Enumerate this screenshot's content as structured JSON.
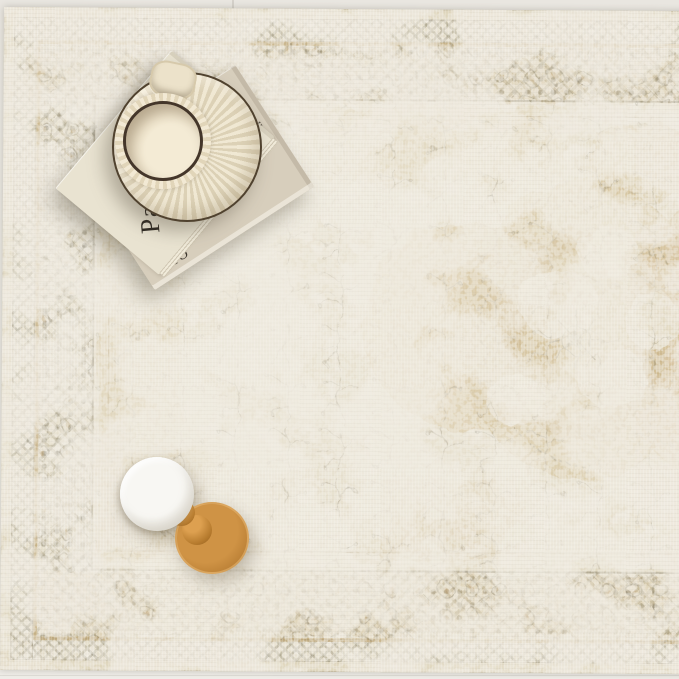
{
  "meta": {
    "alt": "Top-down photo of a cream and tan vintage-style distressed medallion area rug styled with a stack of books, a fluted ceramic cup on a saucer, and a small white lamp with a turned wooden base"
  },
  "objects": {
    "rug": {
      "label": "distressed vintage medallion rug"
    },
    "book_top": {
      "label": "cream hardcover book",
      "title": "Pareille"
    },
    "book_bottom": {
      "label": "greige hardcover book",
      "spine_text": "OIII",
      "corner_mark": "II"
    },
    "cup": {
      "label": "fluted cream cup on fluted saucer with dark rim"
    },
    "lamp": {
      "label": "mini lamp with white shade and turned wood base"
    }
  },
  "palette": {
    "floor": "#e9e6e0",
    "binding": "#e6dfcc",
    "field_cream": "#eee9dd",
    "tan": "#d2ba8c",
    "tan_deep": "#c3a878",
    "olive": "#8e8a77",
    "olive_dark": "#6f6b5a",
    "guard_tan": "#c9ae7e",
    "book1": "#e9e3d1",
    "book2": "#d7cebc",
    "text_dark": "#2f2a23",
    "cup_cream": "#f0e6ce",
    "rim_dark": "#44362a",
    "wood": "#b67b2f",
    "shade_white": "#f4f3ef"
  }
}
